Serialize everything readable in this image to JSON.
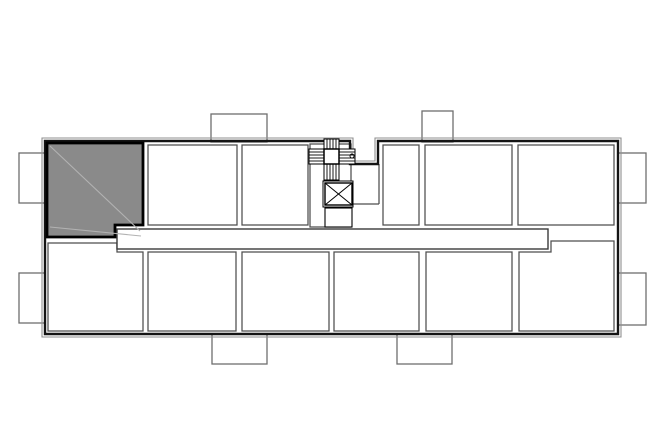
{
  "title": "floor-plan-drawing",
  "canvas": {
    "width": 665,
    "height": 443,
    "background": "#ffffff"
  },
  "colors": {
    "outer_wall": "#141414",
    "outer_offset": "#8f8f8f",
    "room_stroke": "#4d4d4d",
    "corridor_stroke": "#3a3a3a",
    "balcony_stroke": "#6e6e6e",
    "highlight_fill": "#8a8a8a",
    "highlight_border": "#000000",
    "highlight_diag": "#b2b2b2",
    "glyph": "#000000",
    "white": "#ffffff"
  },
  "plan": {
    "outline_main": "45,141 350,141 350,164 378,164 378,141 618,141 618,334 45,334",
    "outline_offset": "42,138 353,138 353,161 375,161 375,138 621,138 621,337 42,337",
    "balconies": [
      {
        "name": "balcony-left-top",
        "rect": [
          19,
          153,
          26,
          50
        ]
      },
      {
        "name": "balcony-left-bottom",
        "rect": [
          19,
          273,
          26,
          50
        ]
      },
      {
        "name": "balcony-top-1",
        "rect": [
          211,
          114,
          56,
          28
        ]
      },
      {
        "name": "balcony-top-2",
        "rect": [
          422,
          111,
          31,
          31
        ]
      },
      {
        "name": "balcony-right-top",
        "rect": [
          618,
          153,
          28,
          50
        ]
      },
      {
        "name": "balcony-right-bottom",
        "rect": [
          618,
          273,
          28,
          52
        ]
      },
      {
        "name": "balcony-bottom-1",
        "rect": [
          212,
          334,
          55,
          30
        ]
      },
      {
        "name": "balcony-bottom-2",
        "rect": [
          397,
          334,
          55,
          30
        ]
      }
    ],
    "rooms": [
      {
        "name": "room-top-2",
        "rect": [
          148,
          145,
          89,
          80
        ]
      },
      {
        "name": "room-top-3",
        "rect": [
          242,
          145,
          66,
          80
        ]
      },
      {
        "name": "stair-core",
        "rect": [
          310,
          144,
          41,
          83
        ]
      },
      {
        "name": "room-top-4",
        "rect": [
          383,
          145,
          36,
          80
        ]
      },
      {
        "name": "room-top-5",
        "rect": [
          425,
          145,
          87,
          80
        ]
      },
      {
        "name": "room-top-6",
        "rect": [
          518,
          145,
          96,
          80
        ]
      },
      {
        "name": "room-bottom-1",
        "points": "48,243 117,243 117,252 143,252 143,331 48,331"
      },
      {
        "name": "room-bottom-2",
        "rect": [
          148,
          252,
          88,
          79
        ]
      },
      {
        "name": "room-bottom-3",
        "rect": [
          242,
          252,
          87,
          79
        ]
      },
      {
        "name": "room-bottom-4",
        "rect": [
          334,
          252,
          85,
          79
        ]
      },
      {
        "name": "room-bottom-5",
        "rect": [
          426,
          252,
          86,
          79
        ]
      },
      {
        "name": "room-bottom-6",
        "points": "519,252 551,252 551,241 614,241 614,331 519,331"
      }
    ],
    "corridor": {
      "name": "corridor",
      "rect": [
        117,
        229,
        431,
        20
      ]
    },
    "entry_lines": [
      [
        352,
        204,
        379,
        204
      ],
      [
        379,
        164,
        379,
        204
      ]
    ],
    "highlight_room": {
      "name": "highlighted-room",
      "points": "47,143 143,143 143,225 115,225 115,237 47,237",
      "diagonals": [
        [
          50,
          146,
          140,
          231
        ],
        [
          50,
          227,
          141,
          236
        ]
      ]
    },
    "stair": {
      "center": [
        324,
        149,
        15,
        15
      ],
      "arms": [
        {
          "rect": [
            324,
            139,
            15,
            10
          ],
          "dir": "v"
        },
        {
          "rect": [
            324,
            164,
            15,
            16
          ],
          "dir": "v"
        },
        {
          "rect": [
            309,
            149,
            15,
            15
          ],
          "dir": "h"
        },
        {
          "rect": [
            339,
            149,
            16,
            15
          ],
          "dir": "h"
        }
      ],
      "hatch_step": 3,
      "circle": [
        352,
        156,
        2
      ]
    },
    "elevator": {
      "outer": [
        323,
        181,
        30,
        26
      ],
      "box": [
        325,
        183,
        27,
        22
      ]
    },
    "shaft_box": [
      325,
      208,
      27,
      19
    ]
  }
}
